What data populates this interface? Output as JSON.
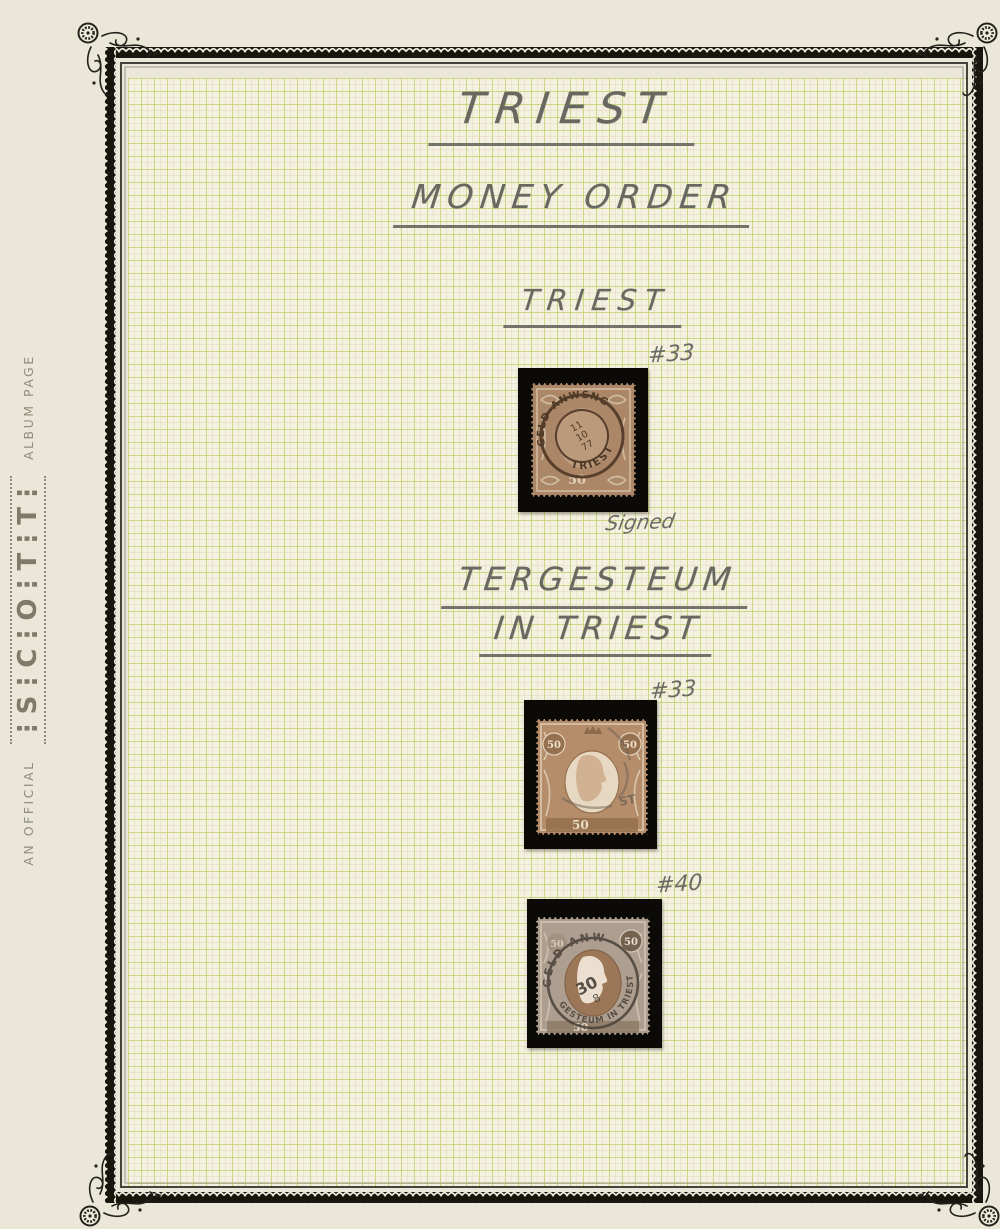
{
  "branding": {
    "prefix": "AN OFFICIAL",
    "brand": "⋮S⋮C⋮O⋮T⋮T⋮",
    "suffix": "ALBUM PAGE"
  },
  "headings": {
    "title": "TRIEST",
    "subtitle": "MONEY ORDER",
    "section1": "TRIEST",
    "section2_line1": "TERGESTEUM",
    "section2_line2": "IN TRIEST"
  },
  "stamps": {
    "s1": {
      "number": "#33",
      "note": "Signed",
      "value": "50",
      "pm_top": "GELD-ANWSNG",
      "pm_bottom": "TRIEST",
      "date1": "11",
      "date2": "10",
      "date3": "77"
    },
    "s2": {
      "number": "#33",
      "value_left": "50",
      "value_right": "50",
      "value_bottom": "50",
      "cancel_fragment": "ST"
    },
    "s3": {
      "number": "#40",
      "value_left": "50",
      "value_right": "50",
      "value_bottom": "50",
      "pm_top": "GELD-ANW",
      "pm_bottom": "GESTEUM IN TRIEST",
      "pm_center": "30",
      "pm_sub": "8"
    }
  },
  "colors": {
    "page_bg": "#eae6d8",
    "grid_bg": "#f3f1e0",
    "grid_line": "#c5d176",
    "frame_black": "#17150e",
    "mount_black": "#0b0a07",
    "pencil": "#686760",
    "stamp1_brown": "#ab8768",
    "stamp2_brown": "#b58d6a",
    "stamp3_drab": "#ae9e8f",
    "cancel_brown": "#573f2c",
    "cancel_gray": "#49423a"
  }
}
